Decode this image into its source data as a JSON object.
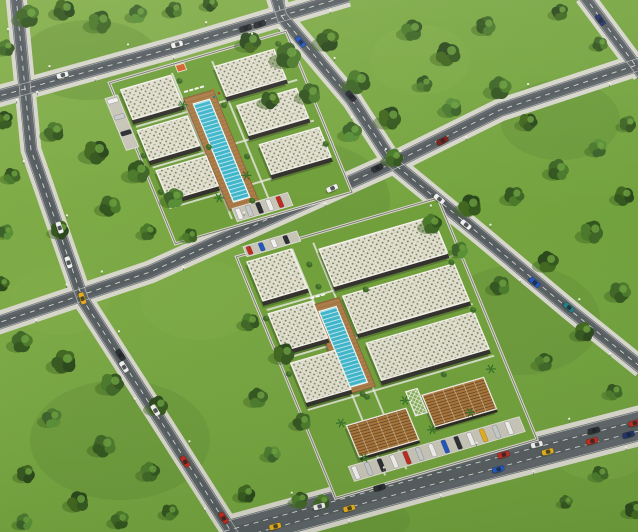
{
  "scene": {
    "kind": "aerial-3d-architectural-render",
    "description": "Oblique aerial render of two gated residential complexes with pools amid tree-filled blocks and a diagonal street grid with traffic",
    "width": 638,
    "height": 532
  },
  "palette": {
    "grass_light": "#86b14d",
    "grass_base": "#74a33e",
    "grass_dark": "#5d8a33",
    "shade_dark": "#41661f",
    "asphalt": "#5e6468",
    "asphalt_dark": "#4c5255",
    "sidewalk": "#d7d6cb",
    "lane_mark": "#e9e9e2",
    "roof_gravel": "#e0ddcf",
    "roof_dot": "#6d7c4b",
    "parapet": "#f4f2ea",
    "facade_dark": "#32312b",
    "facade_wood": "#8a6a42",
    "wood_roof": "#a8763d",
    "wood_roof_line": "#70481f",
    "deck": "#ab7c47",
    "pool_water": "#3eb5ca",
    "pool_lane": "#d6f1f4",
    "parking": "#c7c5b8",
    "kiosk_orange": "#d2622a",
    "tree_tones": [
      [
        "#2a481c",
        "#35581f",
        "#41671f"
      ],
      [
        "#33551f",
        "#3f6626",
        "#4b7a2b"
      ],
      [
        "#3c622a",
        "#4b7a2f",
        "#598f37"
      ]
    ],
    "cars": {
      "white": "#f0f0ee",
      "silver": "#c7cacc",
      "dark": "#2b2e32",
      "red": "#bf2b20",
      "yellow": "#e4ae1e",
      "blue": "#2256c0",
      "navy": "#20316e",
      "teal": "#267d83",
      "darkred": "#7e1f1a"
    }
  },
  "roads": [
    {
      "id": "h1",
      "pts": [
        [
          -8,
          98
        ],
        [
          180,
          46
        ],
        [
          348,
          -4
        ]
      ],
      "w": 13,
      "sw": 4.5,
      "lanes": 1
    },
    {
      "id": "h2",
      "pts": [
        [
          -8,
          325
        ],
        [
          150,
          272
        ],
        [
          393,
          163
        ],
        [
          500,
          110
        ],
        [
          646,
          62
        ]
      ],
      "w": 14,
      "sw": 4.5,
      "lanes": 1
    },
    {
      "id": "h3",
      "pts": [
        [
          226,
          536
        ],
        [
          430,
          480
        ],
        [
          646,
          424
        ]
      ],
      "w": 30,
      "sw": 5,
      "lanes": 2
    },
    {
      "id": "v1",
      "pts": [
        [
          16,
          -4
        ],
        [
          31,
          150
        ],
        [
          83,
          300
        ],
        [
          160,
          420
        ],
        [
          234,
          536
        ]
      ],
      "w": 13,
      "sw": 4,
      "lanes": 1
    },
    {
      "id": "v2",
      "pts": [
        [
          276,
          -4
        ],
        [
          282,
          17
        ],
        [
          352,
          100
        ],
        [
          393,
          163
        ],
        [
          483,
          237
        ],
        [
          570,
          310
        ],
        [
          642,
          368
        ]
      ],
      "w": 13,
      "sw": 4,
      "lanes": 1
    },
    {
      "id": "v3",
      "pts": [
        [
          584,
          -4
        ],
        [
          642,
          74
        ]
      ],
      "w": 12,
      "sw": 4,
      "lanes": 1
    }
  ],
  "lawn_patches": [
    [
      90,
      60,
      70,
      40,
      0
    ],
    [
      300,
      200,
      90,
      60,
      0
    ],
    [
      520,
      320,
      80,
      55,
      0
    ],
    [
      120,
      440,
      90,
      60,
      0
    ],
    [
      560,
      120,
      60,
      40,
      0
    ],
    [
      420,
      60,
      50,
      35,
      1
    ],
    [
      200,
      300,
      60,
      40,
      1
    ],
    [
      600,
      450,
      50,
      30,
      1
    ],
    [
      60,
      300,
      50,
      35,
      1
    ],
    [
      350,
      520,
      60,
      25,
      0
    ]
  ],
  "trees": [
    [
      28,
      16,
      15,
      1
    ],
    [
      64,
      10,
      14,
      0
    ],
    [
      100,
      22,
      15,
      1
    ],
    [
      138,
      14,
      12,
      2
    ],
    [
      174,
      10,
      11,
      1
    ],
    [
      210,
      4,
      10,
      0
    ],
    [
      6,
      48,
      11,
      1
    ],
    [
      4,
      120,
      12,
      0
    ],
    [
      12,
      176,
      11,
      1
    ],
    [
      6,
      232,
      10,
      2
    ],
    [
      2,
      284,
      10,
      0
    ],
    [
      54,
      132,
      13,
      1
    ],
    [
      96,
      152,
      16,
      0
    ],
    [
      138,
      172,
      15,
      1
    ],
    [
      174,
      198,
      13,
      2
    ],
    [
      110,
      206,
      14,
      1
    ],
    [
      60,
      230,
      12,
      0
    ],
    [
      148,
      232,
      11,
      1
    ],
    [
      190,
      236,
      10,
      1
    ],
    [
      250,
      42,
      14,
      0
    ],
    [
      288,
      56,
      17,
      1
    ],
    [
      328,
      40,
      15,
      0
    ],
    [
      358,
      82,
      16,
      1
    ],
    [
      390,
      118,
      15,
      0
    ],
    [
      352,
      132,
      13,
      2
    ],
    [
      310,
      94,
      14,
      1
    ],
    [
      270,
      100,
      12,
      0
    ],
    [
      394,
      158,
      12,
      1
    ],
    [
      412,
      30,
      14,
      1
    ],
    [
      448,
      54,
      16,
      0
    ],
    [
      486,
      26,
      13,
      1
    ],
    [
      500,
      88,
      15,
      1
    ],
    [
      452,
      108,
      13,
      2
    ],
    [
      528,
      122,
      12,
      0
    ],
    [
      424,
      84,
      11,
      1
    ],
    [
      560,
      12,
      11,
      0
    ],
    [
      600,
      44,
      10,
      1
    ],
    [
      628,
      124,
      11,
      1
    ],
    [
      432,
      224,
      13,
      1
    ],
    [
      470,
      206,
      15,
      0
    ],
    [
      514,
      196,
      13,
      1
    ],
    [
      558,
      170,
      14,
      1
    ],
    [
      598,
      148,
      12,
      2
    ],
    [
      624,
      196,
      13,
      0
    ],
    [
      592,
      232,
      15,
      1
    ],
    [
      548,
      262,
      14,
      0
    ],
    [
      500,
      286,
      13,
      1
    ],
    [
      620,
      292,
      14,
      1
    ],
    [
      584,
      332,
      13,
      0
    ],
    [
      544,
      362,
      12,
      1
    ],
    [
      614,
      392,
      11,
      1
    ],
    [
      460,
      250,
      11,
      2
    ],
    [
      22,
      342,
      14,
      1
    ],
    [
      64,
      362,
      16,
      0
    ],
    [
      112,
      384,
      15,
      1
    ],
    [
      158,
      406,
      13,
      0
    ],
    [
      52,
      418,
      13,
      2
    ],
    [
      104,
      446,
      15,
      1
    ],
    [
      26,
      474,
      12,
      0
    ],
    [
      150,
      472,
      13,
      1
    ],
    [
      78,
      502,
      14,
      0
    ],
    [
      170,
      512,
      11,
      1
    ],
    [
      24,
      522,
      11,
      2
    ],
    [
      120,
      520,
      12,
      1
    ],
    [
      250,
      322,
      12,
      1
    ],
    [
      284,
      354,
      14,
      0
    ],
    [
      258,
      398,
      13,
      1
    ],
    [
      302,
      422,
      12,
      1
    ],
    [
      272,
      454,
      11,
      2
    ],
    [
      246,
      494,
      12,
      0
    ],
    [
      300,
      500,
      11,
      1
    ],
    [
      600,
      474,
      11,
      1
    ],
    [
      634,
      510,
      12,
      0
    ],
    [
      566,
      502,
      9,
      1
    ],
    [
      322,
      502,
      10,
      1
    ]
  ],
  "complexes": [
    {
      "id": "north-residential-complex",
      "m": [
        0.96,
        -0.28,
        0.38,
        0.925,
        120,
        88
      ],
      "w": 168,
      "h": 158,
      "paths": {
        "vx": [
          54,
          96
        ],
        "hy": [
          42,
          86,
          130
        ]
      },
      "buildings": [
        {
          "u": 0,
          "v": 2,
          "w": 52,
          "h": 36,
          "kind": "res"
        },
        {
          "u": 0,
          "v": 46,
          "w": 52,
          "h": 36,
          "kind": "res"
        },
        {
          "u": 2,
          "v": 90,
          "w": 52,
          "h": 36,
          "kind": "res"
        },
        {
          "u": 96,
          "v": 6,
          "w": 62,
          "h": 36,
          "kind": "res"
        },
        {
          "u": 102,
          "v": 50,
          "w": 62,
          "h": 36,
          "kind": "res"
        },
        {
          "u": 108,
          "v": 94,
          "w": 62,
          "h": 36,
          "kind": "res"
        }
      ],
      "pool": {
        "u": 62,
        "v": 36,
        "w": 17,
        "h": 106
      },
      "deck": {
        "u": 55,
        "v": 28,
        "w": 31,
        "h": 120
      },
      "loungers": {
        "u": 58,
        "v": 21,
        "n": 4
      },
      "kiosk": {
        "u": 60,
        "v": -6,
        "w": 9,
        "h": 7
      },
      "play": [
        [
          86,
          28
        ],
        [
          90,
          33
        ],
        [
          84,
          35
        ]
      ],
      "parking": [
        {
          "u": 58,
          "v": 148,
          "w": 58,
          "h": 14,
          "cars": 5,
          "dir": "u"
        },
        {
          "u": -18,
          "v": 6,
          "w": 13,
          "h": 56,
          "cars": 3,
          "dir": "v"
        }
      ],
      "palms": [
        [
          52,
          34
        ],
        [
          84,
          120
        ],
        [
          50,
          134
        ]
      ],
      "bushes": [
        [
          58,
          10
        ],
        [
          90,
          46
        ],
        [
          60,
          82
        ],
        [
          92,
          102
        ],
        [
          -4,
          72
        ],
        [
          -2,
          112
        ],
        [
          164,
          2
        ],
        [
          168,
          60
        ],
        [
          170,
          112
        ],
        [
          80,
          146
        ]
      ]
    },
    {
      "id": "south-mixed-use-complex",
      "m": [
        0.96,
        -0.28,
        0.38,
        0.925,
        247,
        262
      ],
      "w": 194,
      "h": 245,
      "paths": {
        "vx": [
          47,
          69
        ],
        "hy": [
          52,
          104,
          160
        ]
      },
      "buildings": [
        {
          "u": 0,
          "v": 0,
          "w": 46,
          "h": 46,
          "kind": "res"
        },
        {
          "u": 0,
          "v": 56,
          "w": 46,
          "h": 44,
          "kind": "res"
        },
        {
          "u": 2,
          "v": 110,
          "w": 46,
          "h": 46,
          "kind": "res"
        },
        {
          "u": 72,
          "v": 8,
          "w": 118,
          "h": 44,
          "kind": "res"
        },
        {
          "u": 76,
          "v": 60,
          "w": 116,
          "h": 44,
          "kind": "res"
        },
        {
          "u": 80,
          "v": 112,
          "w": 112,
          "h": 44,
          "kind": "res"
        },
        {
          "u": 30,
          "v": 186,
          "w": 62,
          "h": 36,
          "kind": "com"
        },
        {
          "u": 112,
          "v": 178,
          "w": 64,
          "h": 36,
          "kind": "com"
        }
      ],
      "pool": {
        "u": 48,
        "v": 68,
        "w": 18,
        "h": 82
      },
      "deck": {
        "u": 42,
        "v": 60,
        "w": 30,
        "h": 96
      },
      "loungers": {
        "u": 45,
        "v": 52,
        "n": 3
      },
      "tower": {
        "u": 98,
        "v": 170,
        "w": 12,
        "h": 26
      },
      "parking": [
        {
          "u": 16,
          "v": 226,
          "w": 178,
          "h": 16,
          "cars": 13,
          "dir": "u"
        },
        {
          "u": 2,
          "v": -16,
          "w": 56,
          "h": 11,
          "cars": 4,
          "dir": "u",
          "colors": [
            "red",
            "blue",
            "white",
            "dark"
          ]
        }
      ],
      "palms": [
        [
          26,
          182
        ],
        [
          94,
          178
        ],
        [
          108,
          214
        ],
        [
          150,
          208
        ],
        [
          34,
          222
        ],
        [
          186,
          172
        ]
      ],
      "bushes": [
        [
          57,
          20
        ],
        [
          57,
          44
        ],
        [
          57,
          160
        ],
        [
          100,
          60
        ],
        [
          -4,
          60
        ],
        [
          -4,
          120
        ],
        [
          190,
          58
        ],
        [
          192,
          110
        ],
        [
          60,
          164
        ],
        [
          140,
          164
        ]
      ]
    }
  ],
  "cars": [
    {
      "road": "h1",
      "t": 0.2,
      "lane": -1,
      "color": "white"
    },
    {
      "road": "h1",
      "t": 0.52,
      "lane": -0.7,
      "color": "white"
    },
    {
      "road": "h1",
      "t": 0.71,
      "lane": 0.5,
      "color": "dark"
    },
    {
      "road": "h1",
      "t": 0.75,
      "lane": 0.5,
      "color": "dark"
    },
    {
      "road": "h2",
      "t": 0.52,
      "lane": -0.5,
      "color": "white"
    },
    {
      "road": "h2",
      "t": 0.59,
      "lane": -0.5,
      "color": "dark"
    },
    {
      "road": "h2",
      "t": 0.69,
      "lane": 0.6,
      "color": "darkred"
    },
    {
      "road": "h3",
      "t": 0.115,
      "lane": 0.5,
      "color": "yellow"
    },
    {
      "road": "h3",
      "t": 0.225,
      "lane": -0.5,
      "color": "white"
    },
    {
      "road": "h3",
      "t": 0.29,
      "lane": 0.8,
      "color": "yellow"
    },
    {
      "road": "h3",
      "t": 0.37,
      "lane": -0.8,
      "color": "dark"
    },
    {
      "road": "h3",
      "t": 0.645,
      "lane": 0.9,
      "color": "blue"
    },
    {
      "road": "h3",
      "t": 0.665,
      "lane": -0.8,
      "color": "red"
    },
    {
      "road": "h3",
      "t": 0.745,
      "lane": -1,
      "color": "white"
    },
    {
      "road": "h3",
      "t": 0.765,
      "lane": 0.3,
      "color": "yellow"
    },
    {
      "road": "h3",
      "t": 0.87,
      "lane": 0.4,
      "color": "red"
    },
    {
      "road": "h3",
      "t": 0.88,
      "lane": -0.9,
      "color": "dark"
    },
    {
      "road": "h3",
      "t": 0.975,
      "lane": -0.5,
      "color": "red"
    },
    {
      "road": "h3",
      "t": 0.955,
      "lane": 0.8,
      "color": "navy"
    },
    {
      "road": "v1",
      "t": 0.4,
      "lane": -0.5,
      "color": "white"
    },
    {
      "road": "v1",
      "t": 0.46,
      "lane": 0.4,
      "color": "white"
    },
    {
      "road": "v1",
      "t": 0.525,
      "lane": 0,
      "color": "yellow"
    },
    {
      "road": "v1",
      "t": 0.64,
      "lane": -0.6,
      "color": "dark"
    },
    {
      "road": "v1",
      "t": 0.66,
      "lane": 0.5,
      "color": "white"
    },
    {
      "road": "v1",
      "t": 0.75,
      "lane": -0.4,
      "color": "white"
    },
    {
      "road": "v1",
      "t": 0.85,
      "lane": 0.4,
      "color": "red"
    },
    {
      "road": "v1",
      "t": 0.965,
      "lane": -0.3,
      "color": "red"
    },
    {
      "road": "v2",
      "t": 0.1,
      "lane": 0.5,
      "color": "blue"
    },
    {
      "road": "v2",
      "t": 0.24,
      "lane": -0.5,
      "color": "dark"
    },
    {
      "road": "v2",
      "t": 0.5,
      "lane": -0.5,
      "color": "white"
    },
    {
      "road": "v2",
      "t": 0.57,
      "lane": 0.4,
      "color": "white"
    },
    {
      "road": "v2",
      "t": 0.74,
      "lane": 0.5,
      "color": "blue"
    },
    {
      "road": "v2",
      "t": 0.82,
      "lane": -0.4,
      "color": "teal"
    },
    {
      "road": "v3",
      "t": 0.3,
      "lane": 0.4,
      "color": "navy"
    }
  ],
  "parked_car_cycle": [
    "white",
    "silver",
    "dark",
    "white",
    "red",
    "silver",
    "white",
    "blue",
    "dark",
    "white",
    "yellow",
    "silver",
    "white"
  ]
}
